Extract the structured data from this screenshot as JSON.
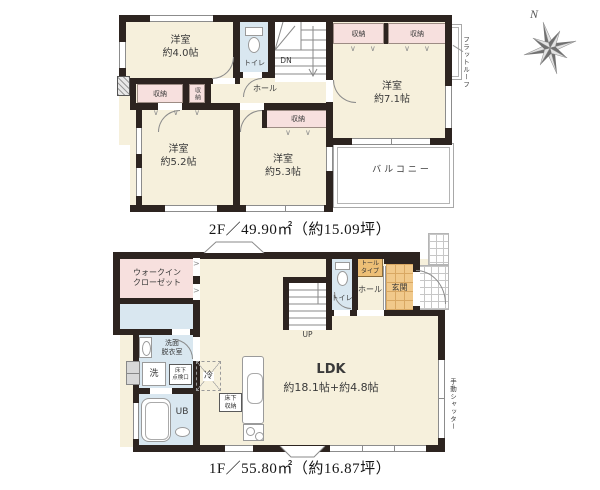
{
  "compass": {
    "label": "N"
  },
  "floor2": {
    "caption": "2F／49.90㎡（約15.09坪）",
    "room40": {
      "name": "洋室",
      "size": "約4.0帖"
    },
    "room52": {
      "name": "洋室",
      "size": "約5.2帖"
    },
    "room53": {
      "name": "洋室",
      "size": "約5.3帖"
    },
    "room71": {
      "name": "洋室",
      "size": "約7.1帖"
    },
    "toilet": "トイレ",
    "hall": "ホール",
    "stairs_dir": "DN",
    "closet": "収納",
    "balcony": "バルコニー",
    "flat_roof": "フラットルーフ"
  },
  "floor1": {
    "caption": "1F／55.80㎡（約16.87坪）",
    "wic": {
      "line1": "ウォークイン",
      "line2": "クローゼット"
    },
    "washroom": {
      "line1": "洗面",
      "line2": "脱衣室"
    },
    "washer": "洗",
    "fridge": "冷",
    "bath": "UB",
    "stairs_dir": "UP",
    "toilet": "トイレ",
    "hall": "ホール",
    "entrance": "玄関",
    "shoe_cabinet": {
      "line1": "トール",
      "line2": "タイプ"
    },
    "underfloor_hatch": {
      "line1": "床下",
      "line2": "点検口"
    },
    "underfloor_storage": {
      "line1": "床下",
      "line2": "収納"
    },
    "ldk": {
      "line1": "LDK",
      "line2": "約18.1帖+約4.8帖"
    },
    "shutter": "手動シャッター"
  }
}
